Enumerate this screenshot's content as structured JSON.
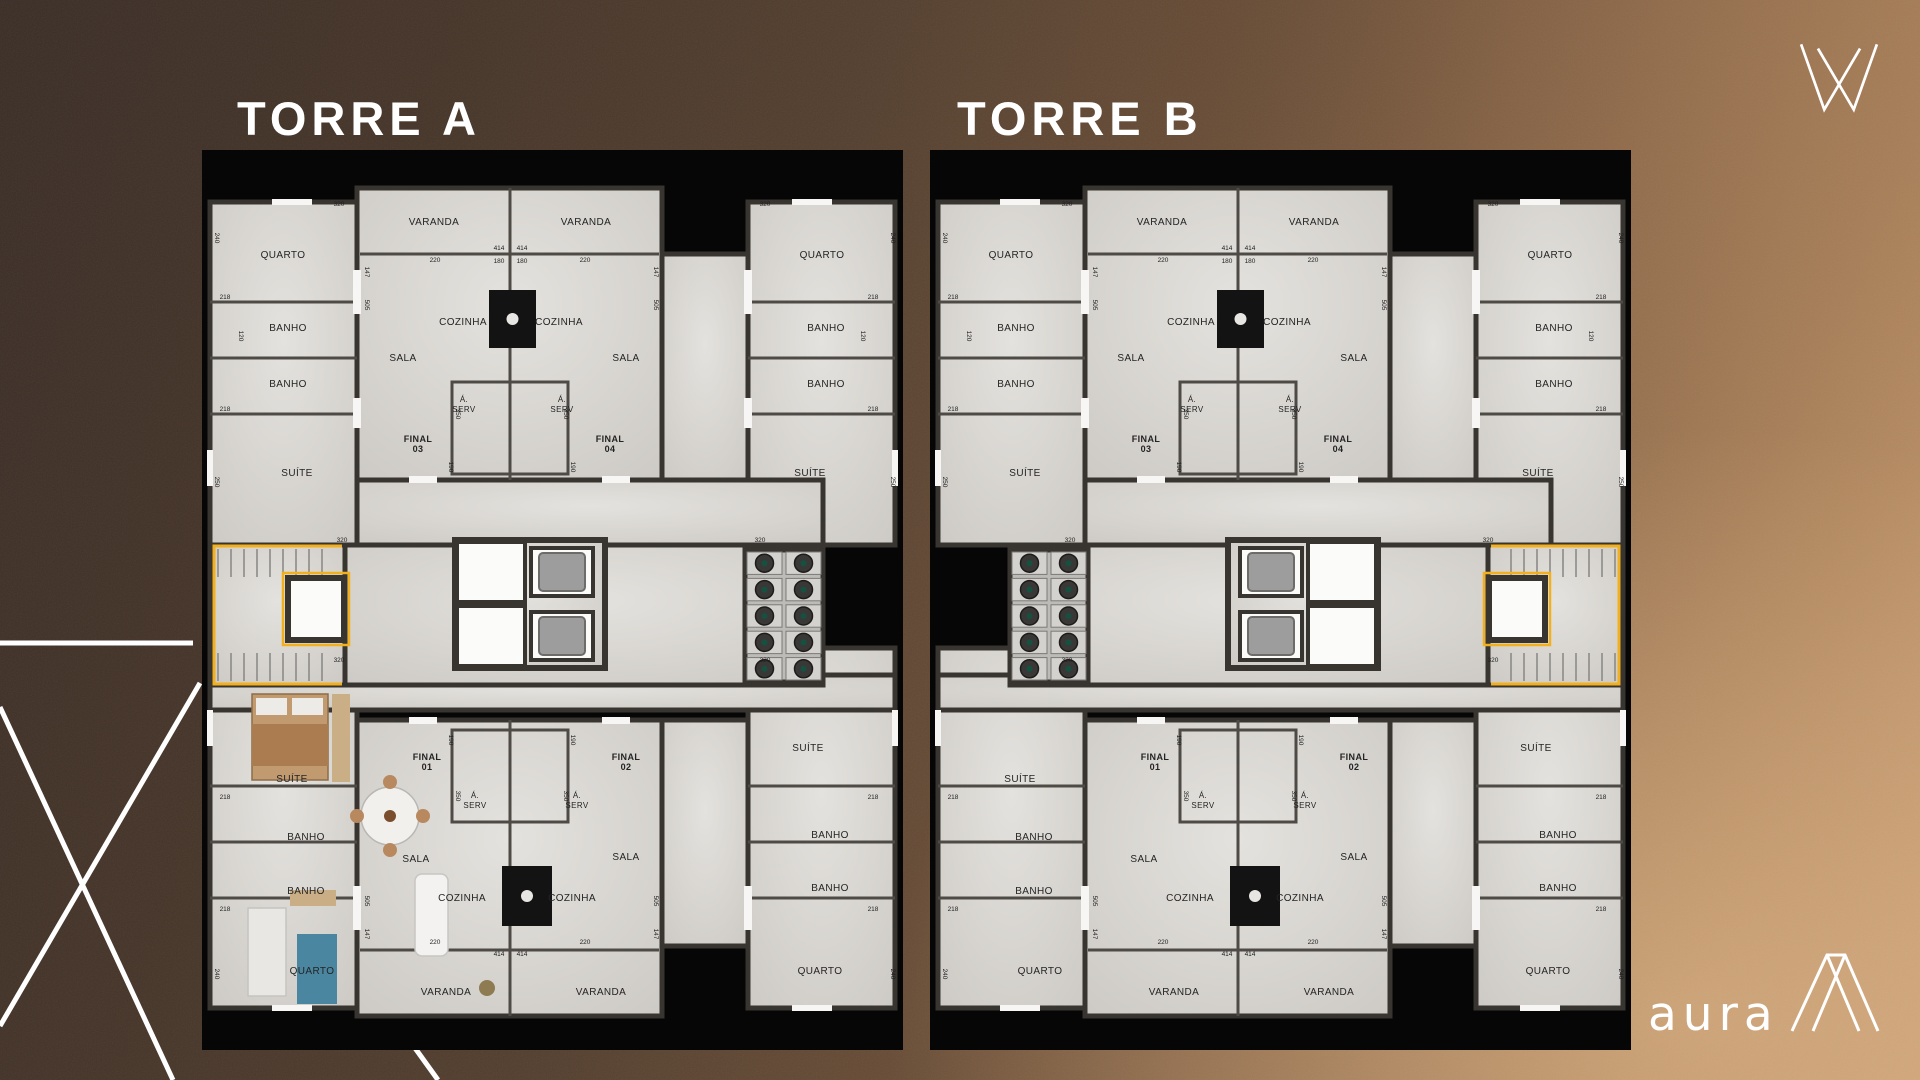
{
  "branding": {
    "logo_text": "aura",
    "brand_mark": "crown-w-mark",
    "aframe_mark": "a-frame-mark",
    "accent_yellow": "#f2b01e"
  },
  "towers": [
    {
      "title": "TORRE A",
      "core_side": "left",
      "furnished": true
    },
    {
      "title": "TORRE B",
      "core_side": "right",
      "furnished": false
    }
  ],
  "plan": {
    "colors": {
      "wall": "#383430",
      "partition": "#4e4a45",
      "floor_hi": "#e4e2de",
      "floor_lo": "#cecbc6",
      "label": "#242424",
      "dim": "#1f1f1f",
      "kitchen": "#131313",
      "cab": "#9d9d9d",
      "shaft": "#fbfbfa",
      "yellow": "#f2b01e",
      "ac_floor": "#bdbbb7",
      "fan": "#3a3836",
      "white": "#f7f6f4",
      "tread": "#8d8b88"
    },
    "floors": [
      [
        8,
        52,
        147,
        343
      ],
      [
        546,
        52,
        147,
        343
      ],
      [
        8,
        498,
        147,
        360
      ],
      [
        546,
        498,
        147,
        360
      ],
      [
        155,
        38,
        305,
        292
      ],
      [
        460,
        104,
        86,
        226
      ],
      [
        155,
        330,
        466,
        65
      ],
      [
        8,
        525,
        685,
        35
      ],
      [
        155,
        570,
        305,
        296
      ],
      [
        460,
        570,
        86,
        226
      ]
    ],
    "partitions": [
      [
        158,
        104,
        457,
        104
      ],
      [
        308,
        38,
        308,
        330
      ],
      [
        8,
        152,
        155,
        152
      ],
      [
        8,
        208,
        155,
        208
      ],
      [
        8,
        264,
        155,
        264
      ],
      [
        546,
        152,
        693,
        152
      ],
      [
        546,
        208,
        693,
        208
      ],
      [
        546,
        264,
        693,
        264
      ],
      [
        158,
        800,
        457,
        800
      ],
      [
        308,
        570,
        308,
        866
      ],
      [
        8,
        636,
        155,
        636
      ],
      [
        8,
        692,
        155,
        692
      ],
      [
        8,
        748,
        155,
        748
      ],
      [
        546,
        636,
        693,
        636
      ],
      [
        546,
        692,
        693,
        692
      ],
      [
        546,
        748,
        693,
        748
      ]
    ],
    "serv_rooms": [
      [
        250,
        232,
        58,
        92
      ],
      [
        308,
        232,
        58,
        92
      ],
      [
        250,
        580,
        58,
        92
      ],
      [
        308,
        580,
        58,
        92
      ]
    ],
    "kitchens": [
      [
        287,
        140,
        47,
        58
      ],
      [
        300,
        716,
        50,
        60
      ]
    ],
    "whites": [
      [
        207,
        326,
        28,
        7
      ],
      [
        400,
        326,
        28,
        7
      ],
      [
        207,
        567,
        28,
        7
      ],
      [
        400,
        567,
        28,
        7
      ],
      [
        151,
        120,
        8,
        44
      ],
      [
        151,
        248,
        8,
        30
      ],
      [
        542,
        120,
        8,
        44
      ],
      [
        542,
        248,
        8,
        30
      ],
      [
        151,
        736,
        8,
        44
      ],
      [
        542,
        736,
        8,
        44
      ],
      [
        70,
        49,
        40,
        6
      ],
      [
        590,
        49,
        40,
        6
      ],
      [
        70,
        855,
        40,
        6
      ],
      [
        590,
        855,
        40,
        6
      ],
      [
        5,
        300,
        6,
        36
      ],
      [
        690,
        300,
        6,
        36
      ],
      [
        5,
        560,
        6,
        36
      ],
      [
        690,
        560,
        6,
        36
      ]
    ],
    "labels": [
      {
        "t": "QUARTO",
        "x": 81,
        "y": 108
      },
      {
        "t": "QUARTO",
        "x": 620,
        "y": 108
      },
      {
        "t": "VARANDA",
        "x": 232,
        "y": 75
      },
      {
        "t": "VARANDA",
        "x": 384,
        "y": 75
      },
      {
        "t": "BANHO",
        "x": 86,
        "y": 181
      },
      {
        "t": "BANHO",
        "x": 86,
        "y": 237
      },
      {
        "t": "BANHO",
        "x": 624,
        "y": 181
      },
      {
        "t": "BANHO",
        "x": 624,
        "y": 237
      },
      {
        "t": "SALA",
        "x": 201,
        "y": 211
      },
      {
        "t": "SALA",
        "x": 424,
        "y": 211
      },
      {
        "t": "COZINHA",
        "x": 261,
        "y": 175
      },
      {
        "t": "COZINHA",
        "x": 357,
        "y": 175
      },
      {
        "lines": [
          "Á.",
          "SERV"
        ],
        "x": 262,
        "y": 252,
        "s": 8
      },
      {
        "lines": [
          "Á.",
          "SERV"
        ],
        "x": 360,
        "y": 252,
        "s": 8
      },
      {
        "lines": [
          "FINAL",
          "03"
        ],
        "x": 216,
        "y": 292,
        "b": 1,
        "s": 9
      },
      {
        "lines": [
          "FINAL",
          "04"
        ],
        "x": 408,
        "y": 292,
        "b": 1,
        "s": 9
      },
      {
        "t": "SUÍTE",
        "x": 95,
        "y": 326
      },
      {
        "t": "SUÍTE",
        "x": 608,
        "y": 326
      },
      {
        "t": "SUÍTE",
        "x": 90,
        "y": 632
      },
      {
        "t": "SUÍTE",
        "x": 606,
        "y": 601
      },
      {
        "t": "BANHO",
        "x": 104,
        "y": 690
      },
      {
        "t": "BANHO",
        "x": 104,
        "y": 744
      },
      {
        "t": "BANHO",
        "x": 628,
        "y": 688
      },
      {
        "t": "BANHO",
        "x": 628,
        "y": 741
      },
      {
        "t": "QUARTO",
        "x": 110,
        "y": 824
      },
      {
        "t": "QUARTO",
        "x": 618,
        "y": 824
      },
      {
        "lines": [
          "FINAL",
          "01"
        ],
        "x": 225,
        "y": 610,
        "b": 1,
        "s": 9
      },
      {
        "lines": [
          "FINAL",
          "02"
        ],
        "x": 424,
        "y": 610,
        "b": 1,
        "s": 9
      },
      {
        "lines": [
          "Á.",
          "SERV"
        ],
        "x": 273,
        "y": 648,
        "s": 8
      },
      {
        "lines": [
          "Á.",
          "SERV"
        ],
        "x": 375,
        "y": 648,
        "s": 8
      },
      {
        "t": "SALA",
        "x": 214,
        "y": 712
      },
      {
        "t": "SALA",
        "x": 424,
        "y": 710
      },
      {
        "t": "COZINHA",
        "x": 260,
        "y": 751
      },
      {
        "t": "COZINHA",
        "x": 370,
        "y": 751
      },
      {
        "t": "VARANDA",
        "x": 244,
        "y": 845
      },
      {
        "t": "VARANDA",
        "x": 399,
        "y": 845
      }
    ],
    "dims": [
      [
        "320",
        137,
        56,
        0
      ],
      [
        "240",
        13,
        88,
        1
      ],
      [
        "320",
        563,
        56,
        0
      ],
      [
        "240",
        689,
        88,
        1
      ],
      [
        "147",
        163,
        122,
        1
      ],
      [
        "505",
        163,
        155,
        1
      ],
      [
        "147",
        452,
        122,
        1
      ],
      [
        "505",
        452,
        155,
        1
      ],
      [
        "414",
        297,
        100,
        0
      ],
      [
        "414",
        320,
        100,
        0
      ],
      [
        "220",
        233,
        112,
        0
      ],
      [
        "220",
        383,
        112,
        0
      ],
      [
        "180",
        297,
        113,
        0
      ],
      [
        "180",
        320,
        113,
        0
      ],
      [
        "218",
        23,
        149,
        0
      ],
      [
        "218",
        671,
        149,
        0
      ],
      [
        "218",
        23,
        261,
        0
      ],
      [
        "218",
        671,
        261,
        0
      ],
      [
        "120",
        37,
        186,
        1
      ],
      [
        "120",
        659,
        186,
        1
      ],
      [
        "250",
        13,
        332,
        1
      ],
      [
        "250",
        689,
        332,
        1
      ],
      [
        "350",
        254,
        264,
        1
      ],
      [
        "350",
        362,
        264,
        1
      ],
      [
        "190",
        247,
        317,
        1
      ],
      [
        "190",
        369,
        317,
        1
      ],
      [
        "320",
        140,
        392,
        0
      ],
      [
        "320",
        558,
        392,
        0
      ],
      [
        "320",
        137,
        512,
        0
      ],
      [
        "320",
        563,
        512,
        0
      ],
      [
        "218",
        23,
        649,
        0
      ],
      [
        "218",
        671,
        649,
        0
      ],
      [
        "218",
        23,
        761,
        0
      ],
      [
        "218",
        671,
        761,
        0
      ],
      [
        "240",
        13,
        824,
        1
      ],
      [
        "240",
        689,
        824,
        1
      ],
      [
        "147",
        163,
        784,
        1
      ],
      [
        "505",
        163,
        751,
        1
      ],
      [
        "147",
        452,
        784,
        1
      ],
      [
        "505",
        452,
        751,
        1
      ],
      [
        "220",
        233,
        794,
        0
      ],
      [
        "220",
        383,
        794,
        0
      ],
      [
        "414",
        297,
        806,
        0
      ],
      [
        "414",
        320,
        806,
        0
      ],
      [
        "350",
        254,
        646,
        1
      ],
      [
        "350",
        362,
        646,
        1
      ],
      [
        "190",
        247,
        590,
        1
      ],
      [
        "190",
        369,
        590,
        1
      ]
    ],
    "core": {
      "mid": [
        143,
        395,
        478,
        140
      ],
      "stairzone": [
        8,
        395,
        135,
        140
      ],
      "shaft": [
        86,
        428,
        56,
        62
      ],
      "yellow": "140,396 12,396 12,534 140,534",
      "elev": {
        "bank": [
          253,
          390,
          150,
          128
        ],
        "shafts": [
          [
            255,
            392,
            68,
            60
          ],
          [
            255,
            456,
            68,
            60
          ]
        ],
        "cabs": [
          [
            329,
            398,
            62,
            48
          ],
          [
            329,
            462,
            62,
            48
          ]
        ]
      },
      "ac": {
        "rect": [
          543,
          400,
          78,
          132
        ],
        "rows": 5,
        "cols": 2
      }
    },
    "furniture": [
      {
        "k": "rect",
        "x": 50,
        "y": 544,
        "w": 76,
        "h": 86,
        "f": "#c29a70",
        "s": "#8d6c49"
      },
      {
        "k": "rect",
        "x": 54,
        "y": 548,
        "w": 31,
        "h": 17,
        "f": "#edebe7"
      },
      {
        "k": "rect",
        "x": 90,
        "y": 548,
        "w": 31,
        "h": 17,
        "f": "#edebe7"
      },
      {
        "k": "rect",
        "x": 50,
        "y": 574,
        "w": 76,
        "h": 42,
        "f": "#aa7c50"
      },
      {
        "k": "rect",
        "x": 130,
        "y": 544,
        "w": 18,
        "h": 88,
        "f": "#c9ae86"
      },
      {
        "k": "circle",
        "cx": 188,
        "cy": 666,
        "r": 29,
        "f": "#f1f0ed",
        "s": "#b9b7b3"
      },
      {
        "k": "circle",
        "cx": 188,
        "cy": 632,
        "r": 7,
        "f": "#b8895e"
      },
      {
        "k": "circle",
        "cx": 188,
        "cy": 700,
        "r": 7,
        "f": "#b8895e"
      },
      {
        "k": "circle",
        "cx": 155,
        "cy": 666,
        "r": 7,
        "f": "#b8895e"
      },
      {
        "k": "circle",
        "cx": 221,
        "cy": 666,
        "r": 7,
        "f": "#b8895e"
      },
      {
        "k": "circle",
        "cx": 188,
        "cy": 666,
        "r": 6,
        "f": "#7a4e2d"
      },
      {
        "k": "rect",
        "x": 213,
        "y": 724,
        "w": 33,
        "h": 82,
        "f": "#f3f2f0",
        "s": "#c8c6c2",
        "rx": 7
      },
      {
        "k": "rect",
        "x": 95,
        "y": 784,
        "w": 40,
        "h": 70,
        "f": "#4a86a0"
      },
      {
        "k": "rect",
        "x": 46,
        "y": 758,
        "w": 38,
        "h": 88,
        "f": "#e9e7e3",
        "s": "#c6c4c0"
      },
      {
        "k": "rect",
        "x": 88,
        "y": 740,
        "w": 46,
        "h": 16,
        "f": "#c9ae86"
      },
      {
        "k": "circle",
        "cx": 285,
        "cy": 838,
        "r": 8,
        "f": "#8f7b52"
      }
    ]
  },
  "decor": {
    "lines": [
      [
        0,
        643,
        193,
        643
      ],
      [
        200,
        683,
        0,
        1026
      ],
      [
        0,
        707,
        173,
        1080
      ],
      [
        415,
        1048,
        438,
        1080
      ]
    ]
  }
}
